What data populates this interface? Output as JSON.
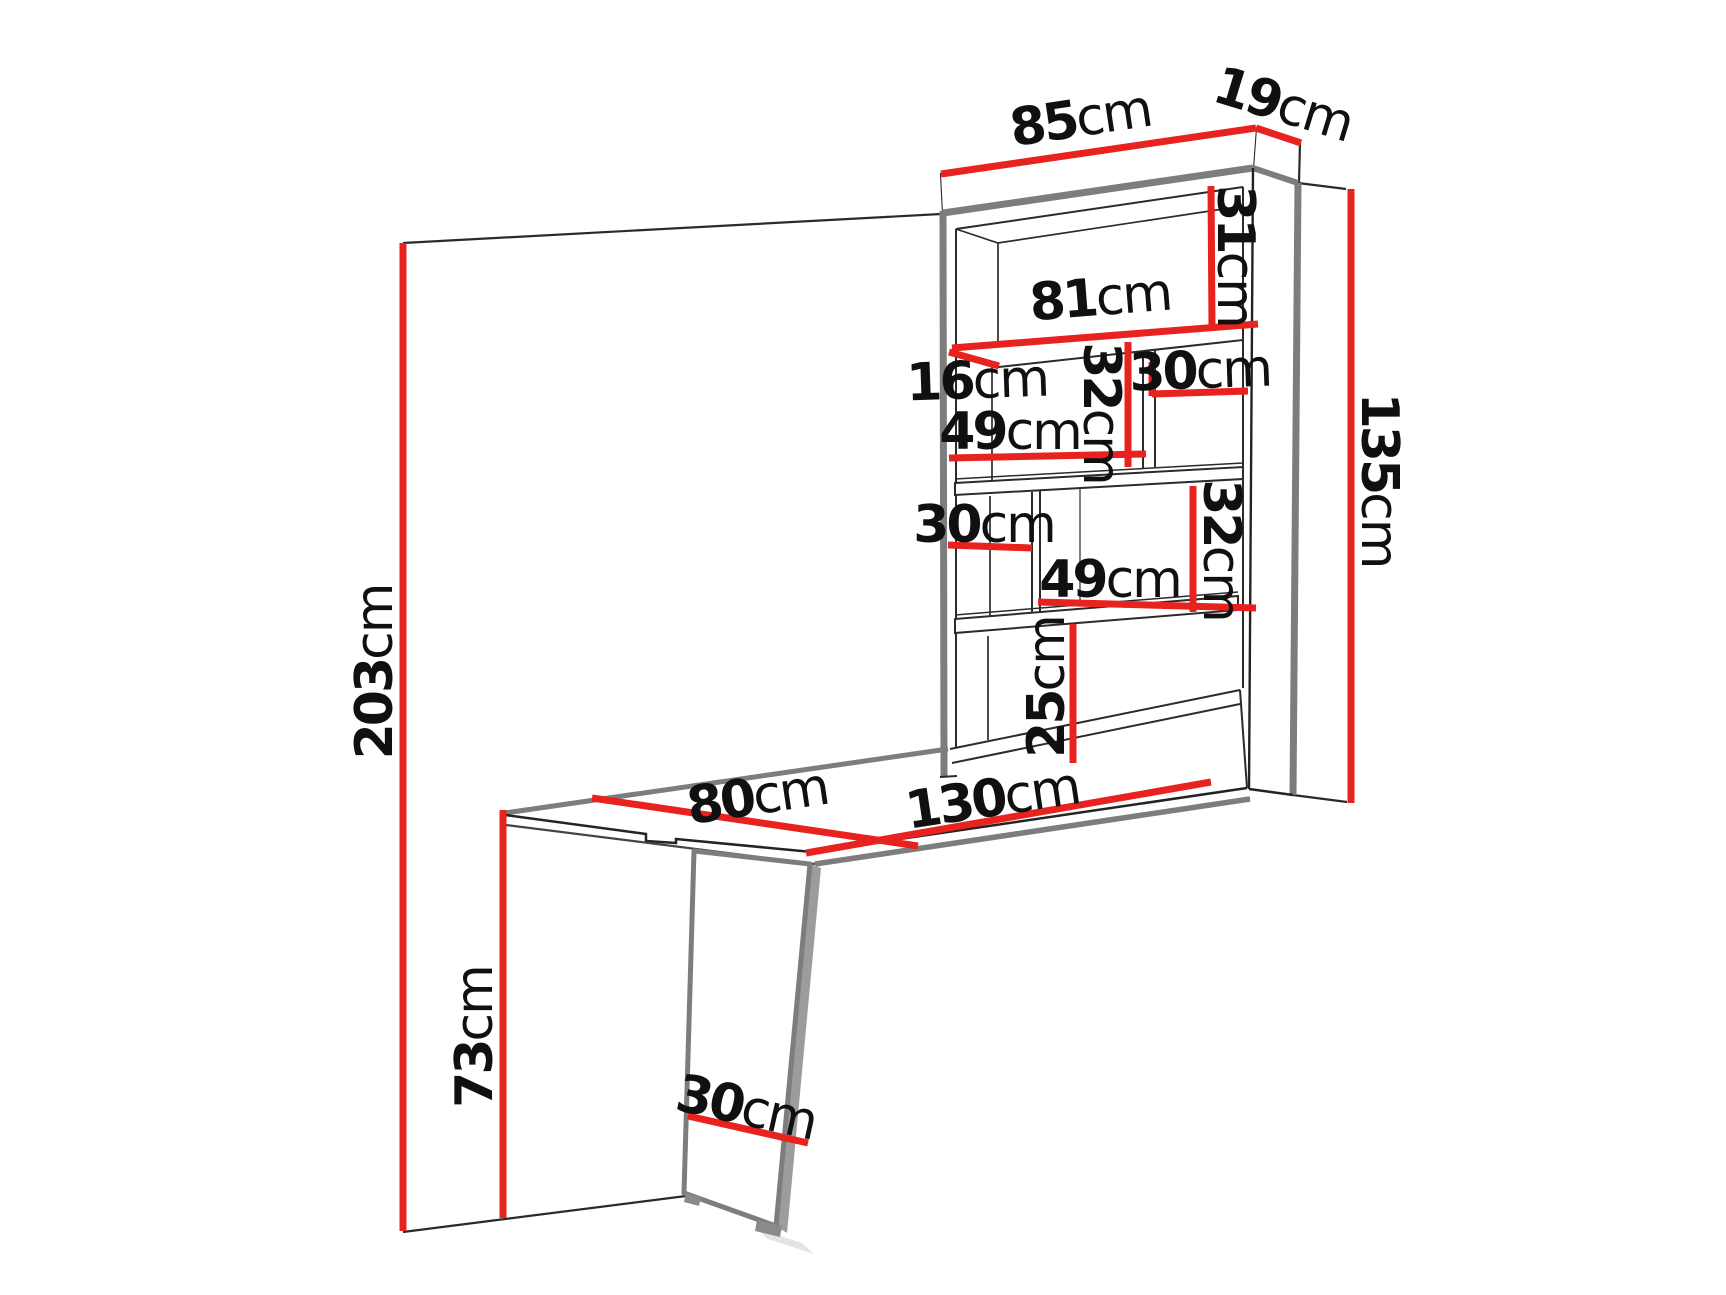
{
  "diagram": {
    "type": "furniture-dimension-drawing",
    "subject": "wall-mounted fold-out desk with shelf cabinet",
    "measurement_unit": "cm",
    "colors": {
      "dimension_line": "#e8221e",
      "structure_gray": "#7d7d7d",
      "structure_black": "#232323",
      "background": "#ffffff",
      "label_text": "#101010"
    },
    "dimensions": {
      "cabinet_width": {
        "value": "85",
        "unit": "cm"
      },
      "cabinet_depth": {
        "value": "19",
        "unit": "cm"
      },
      "top_compartment_height": {
        "value": "31",
        "unit": "cm"
      },
      "interior_width": {
        "value": "81",
        "unit": "cm"
      },
      "shelf_depth": {
        "value": "16",
        "unit": "cm"
      },
      "upper_right_compartment_width": {
        "value": "30",
        "unit": "cm"
      },
      "upper_left_compartment_width": {
        "value": "49",
        "unit": "cm"
      },
      "upper_compartment_height": {
        "value": "32",
        "unit": "cm"
      },
      "cabinet_height": {
        "value": "135",
        "unit": "cm"
      },
      "middle_left_compartment_width": {
        "value": "30",
        "unit": "cm"
      },
      "lower_right_compartment_width": {
        "value": "49",
        "unit": "cm"
      },
      "lower_compartment_height": {
        "value": "32",
        "unit": "cm"
      },
      "bottom_compartment_height": {
        "value": "25",
        "unit": "cm"
      },
      "total_height": {
        "value": "203",
        "unit": "cm"
      },
      "desk_width": {
        "value": "80",
        "unit": "cm"
      },
      "desk_length": {
        "value": "130",
        "unit": "cm"
      },
      "desk_height": {
        "value": "73",
        "unit": "cm"
      },
      "leg_panel_width": {
        "value": "30",
        "unit": "cm"
      }
    }
  }
}
